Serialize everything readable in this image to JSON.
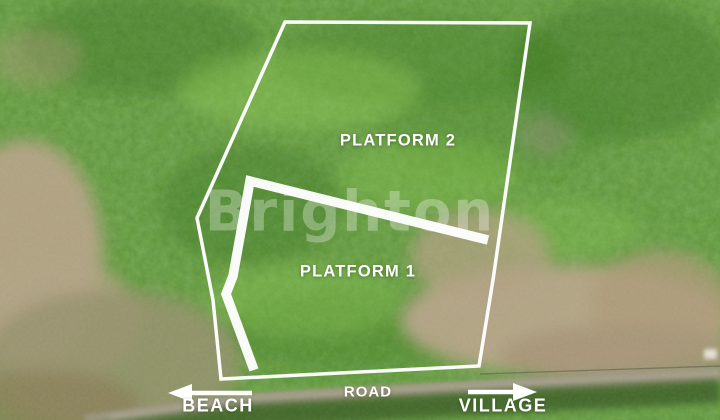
{
  "scene": {
    "kind": "aerial-drone-photo",
    "subject": "forested land plots beside a road"
  },
  "labels": {
    "platform_2": "PLATFORM 2",
    "platform_1": "PLATFORM 1",
    "road": "ROAD",
    "beach": "BEACH",
    "village": "VILLAGE"
  },
  "watermark": {
    "text": "Brighton"
  },
  "colors": {
    "annotation_white": "#ffffff",
    "forest_green_base": "#578f31",
    "forest_green_dark": "#39701f",
    "forest_green_light": "#8cc653",
    "dirt_tan": "#b5a287",
    "scrub_olive": "#95906c",
    "road_gray": "#9a947f"
  }
}
